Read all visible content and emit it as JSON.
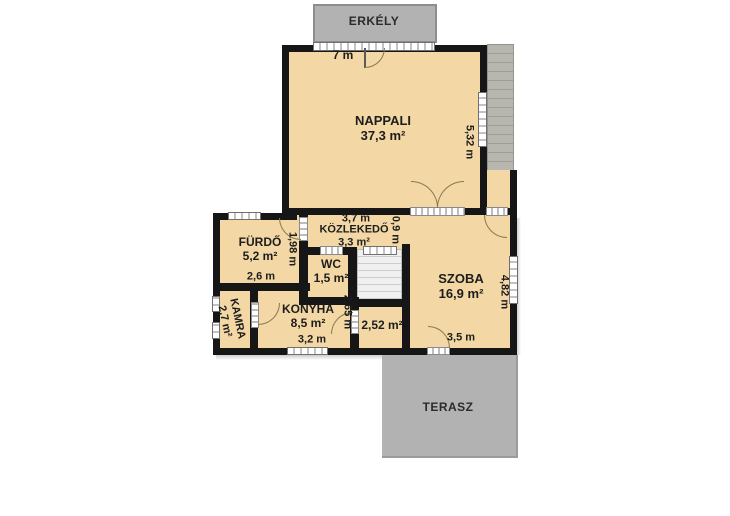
{
  "outdoor": {
    "balcony_label": "ERKÉLY",
    "terrace_label": "TERASZ"
  },
  "rooms": {
    "nappali": {
      "name": "NAPPALI",
      "area": "37,3 m²"
    },
    "furdo": {
      "name": "FÜRDŐ",
      "area": "5,2 m²"
    },
    "kozlekedo": {
      "name": "KÖZLEKEDŐ",
      "area": "3,3 m²"
    },
    "wc": {
      "name": "WC",
      "area": "1,5 m²"
    },
    "szoba": {
      "name": "SZOBA",
      "area": "16,9 m²"
    },
    "kamra": {
      "name": "KAMRA",
      "area": "2,7 m²"
    },
    "konyha": {
      "name": "KONYHA",
      "area": "8,5 m²"
    },
    "storage": {
      "area": "2,52 m²"
    }
  },
  "dimensions": {
    "balcony_front": "7 m",
    "nappali_depth": "5,32 m",
    "furdo_width": "2,6 m",
    "furdo_depth": "1,98 m",
    "kozlekedo_length": "3,7 m",
    "kozlekedo_width": "0,9 m",
    "konyha_width": "3,2 m",
    "konyha_depth": "2,65 m",
    "szoba_width": "3,5 m",
    "szoba_depth": "4,82 m"
  },
  "colors": {
    "floor": "#f3d8a5",
    "wall": "#161616",
    "outdoor_gray": "#b2b2b2",
    "door_arc": "#8a7a52"
  }
}
